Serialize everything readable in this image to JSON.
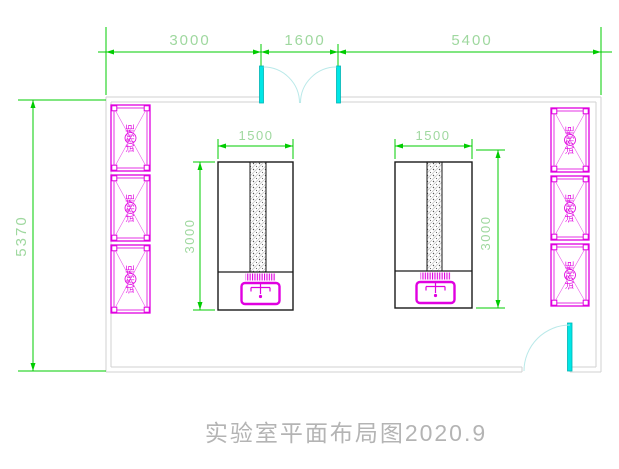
{
  "title": "实验室平面布局图2020.9",
  "dimensions": {
    "top": [
      "3000",
      "1600",
      "5400"
    ],
    "left_total": "5370"
  },
  "islands": [
    {
      "width": "1500",
      "length": "3000"
    },
    {
      "width": "1500",
      "length": "3000"
    }
  ],
  "cabinets": {
    "left": [
      "试剂柜",
      "试剂柜",
      "试剂柜"
    ],
    "right": [
      "试剂柜",
      "试剂柜",
      "试剂柜"
    ]
  },
  "colors": {
    "dimension_green": "#00cc00",
    "dimension_text_green": "#9fd89f",
    "cabinet_magenta": "#e000e0",
    "door_cyan": "#00e6e6",
    "wall_gray": "#d2d2d2",
    "bench_black": "#1a1a1a",
    "title_gray": "#b4b4b4"
  }
}
